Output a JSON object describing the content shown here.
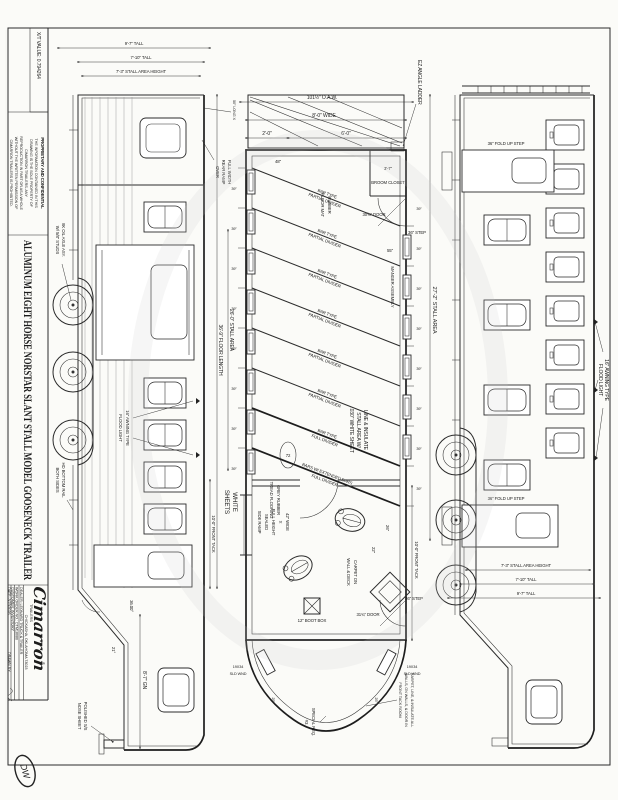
{
  "titleblock": {
    "xt": "X/T VALUE:   0.794264",
    "prop_title": "PROPRIETARY AND CONFIDENTIAL",
    "prop_lines": [
      "THE INFORMATION CONTAINED IN THIS",
      "DRAWING IS THE SOLE PROPERTY OF",
      "CIMARRON TRAILERS.  ANY",
      "REPRODUCTION IN PART OR AS A WHOLE",
      "WITHOUT THE WRITTEN PERMISSION OF",
      "CIMARRON TRAILERS IS PROHIBITED."
    ],
    "drawing_title": "ALUMINUM EIGHT HORSE NORSTAR SLANT STALL MODEL GOOSENECK TRAILER",
    "logo": "Cimarron",
    "logo_sub": "TRAILERS",
    "logo_reg": "®",
    "city": "CHICKASHA, OKLAHOMA 73023",
    "dealer": "DEALER:   LEONARD TRUCK & TRAILER",
    "work_order": "WORK ORDER NO.:   CTM18080",
    "customer": "CUSTOMER:   INVENTORY",
    "date_row": "DATE:   3/19/2026",
    "drawn_by": "DRAWN BY:",
    "signature": "DW"
  },
  "curb": {
    "flood1": "16\" AWNING TYPE",
    "flood2": "FLOOD LIGHT",
    "stall_area": "27'-2\" STALL AREA",
    "step": "36\" FOLD UP STEP",
    "h_stall": "7'-3\" STALL AREA HEIGHT",
    "h_tall": "7'-10\" TALL",
    "h_overall": "9'-7\" TALL"
  },
  "plan": {
    "oaw": "101½\" O.A.W.",
    "wide": "8'-0\" WIDE",
    "d60": "6'-0\"",
    "d20": "2'-0\"",
    "ladder": "EZ ANGLE LADDER",
    "rubber1": "RUBBER",
    "rubber2": "FLOOR MAT",
    "insul1": "LINE & INSULATE",
    "insul2": "STALL AREA W/",
    "insul3": ".030\" WHITE SHEET",
    "manger": "MANGER ASSEMBLY",
    "div1": "BAR TYPE",
    "div2": "PARTIAL DIVIDER",
    "full1": "BAR TYPE",
    "full2": "FULL DIVIDER",
    "ext1": "BARS W/ EXTENDED BARS",
    "ext2": "FULL DIVIDER",
    "stall_w": "39\"",
    "broom_dim": "3'-7\"",
    "broom": "BROOM CLOSET",
    "door_rear": "30⅝\" DOOR",
    "door_front": "31¾\" DOOR",
    "step": "36\" STEP",
    "d55": "55\"",
    "d48": "48\"",
    "d72": "72",
    "d25": "25\"",
    "d22": "22\"",
    "d26": "26\"",
    "tread1": "GREY RUBBER",
    "tread2": "TREAD FLOORING",
    "ramp1": "42\" WIDE",
    "ramp2": "X",
    "ramp3": "FULL HEIGHT",
    "ramp4": "SEALED",
    "ramp5": "SIDE RAMP",
    "boot": "12\" BOOT BOX",
    "carpet1": "CARPET ON",
    "carpet2": "WALL & DECK",
    "wnd1": "19X34",
    "wnd2": "SLD WND",
    "front_tack": "10'-0\" FRONT TACK",
    "special1": "SPECIAL REQ.",
    "special2": "#3",
    "note1": "CARPET, LINE, & INSULATE ALL",
    "note2": "WALLS, GN WALLS, & DOOR IN",
    "note3": "FRONT TACK ROOM"
  },
  "street": {
    "stall_area": "26'-0\" STALL AREA",
    "floor_len": "36'-9\" FLOOR LENGTH",
    "front_tack": "10'-0\" FRONT TACK",
    "ramp1": "FULL WIDTH",
    "ramp2": "REAR RAMP",
    "ramp3": "OVER",
    "long50": "50\" LONG X",
    "white1": "WHITE",
    "white2": "SHEETS",
    "axle1": "8K OIL AXLE ASY.",
    "axle2": "W/ 5/8\" STUDS",
    "rail1": "HD BOTTOM RAIL",
    "rail2": "BOTH SIDES",
    "nose1": "POLISHED S/S",
    "nose2": "NOSE SHEET",
    "gn": "8'-7\" GN",
    "flood1": "16\" AWNING TYPE",
    "flood2": "FLOOD LIGHT",
    "ang36": "36.00°",
    "ang21": "21°"
  }
}
